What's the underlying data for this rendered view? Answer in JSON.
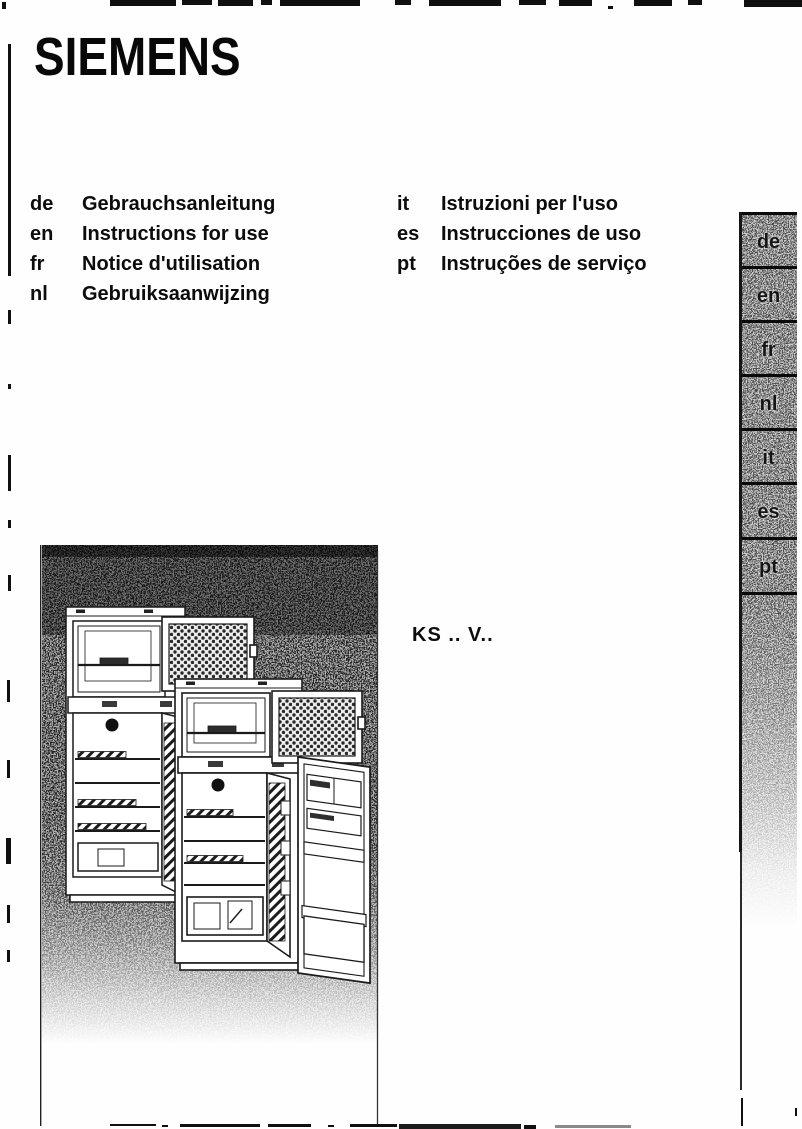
{
  "brand": "SIEMENS",
  "model": "KS .. V..",
  "langs_left": [
    {
      "code": "de",
      "label": "Gebrauchsanleitung"
    },
    {
      "code": "en",
      "label": "Instructions for use"
    },
    {
      "code": "fr",
      "label": "Notice d'utilisation"
    },
    {
      "code": "nl",
      "label": "Gebruiksaanwijzing"
    }
  ],
  "langs_right": [
    {
      "code": "it",
      "label": "Istruzioni per l'uso"
    },
    {
      "code": "es",
      "label": "Instrucciones de uso"
    },
    {
      "code": "pt",
      "label": "Instruções de serviço"
    }
  ],
  "sidebar_tabs": [
    "de",
    "en",
    "fr",
    "nl",
    "it",
    "es",
    "pt"
  ],
  "illustration": {
    "description": "Halftone line drawing of two top-freezer refrigerators with doors open"
  },
  "colors": {
    "ink": "#0d0d0d",
    "paper": "#fefefe",
    "halftone_dark": "#4a4a4a",
    "tab_gray": "#9a9a9a"
  }
}
